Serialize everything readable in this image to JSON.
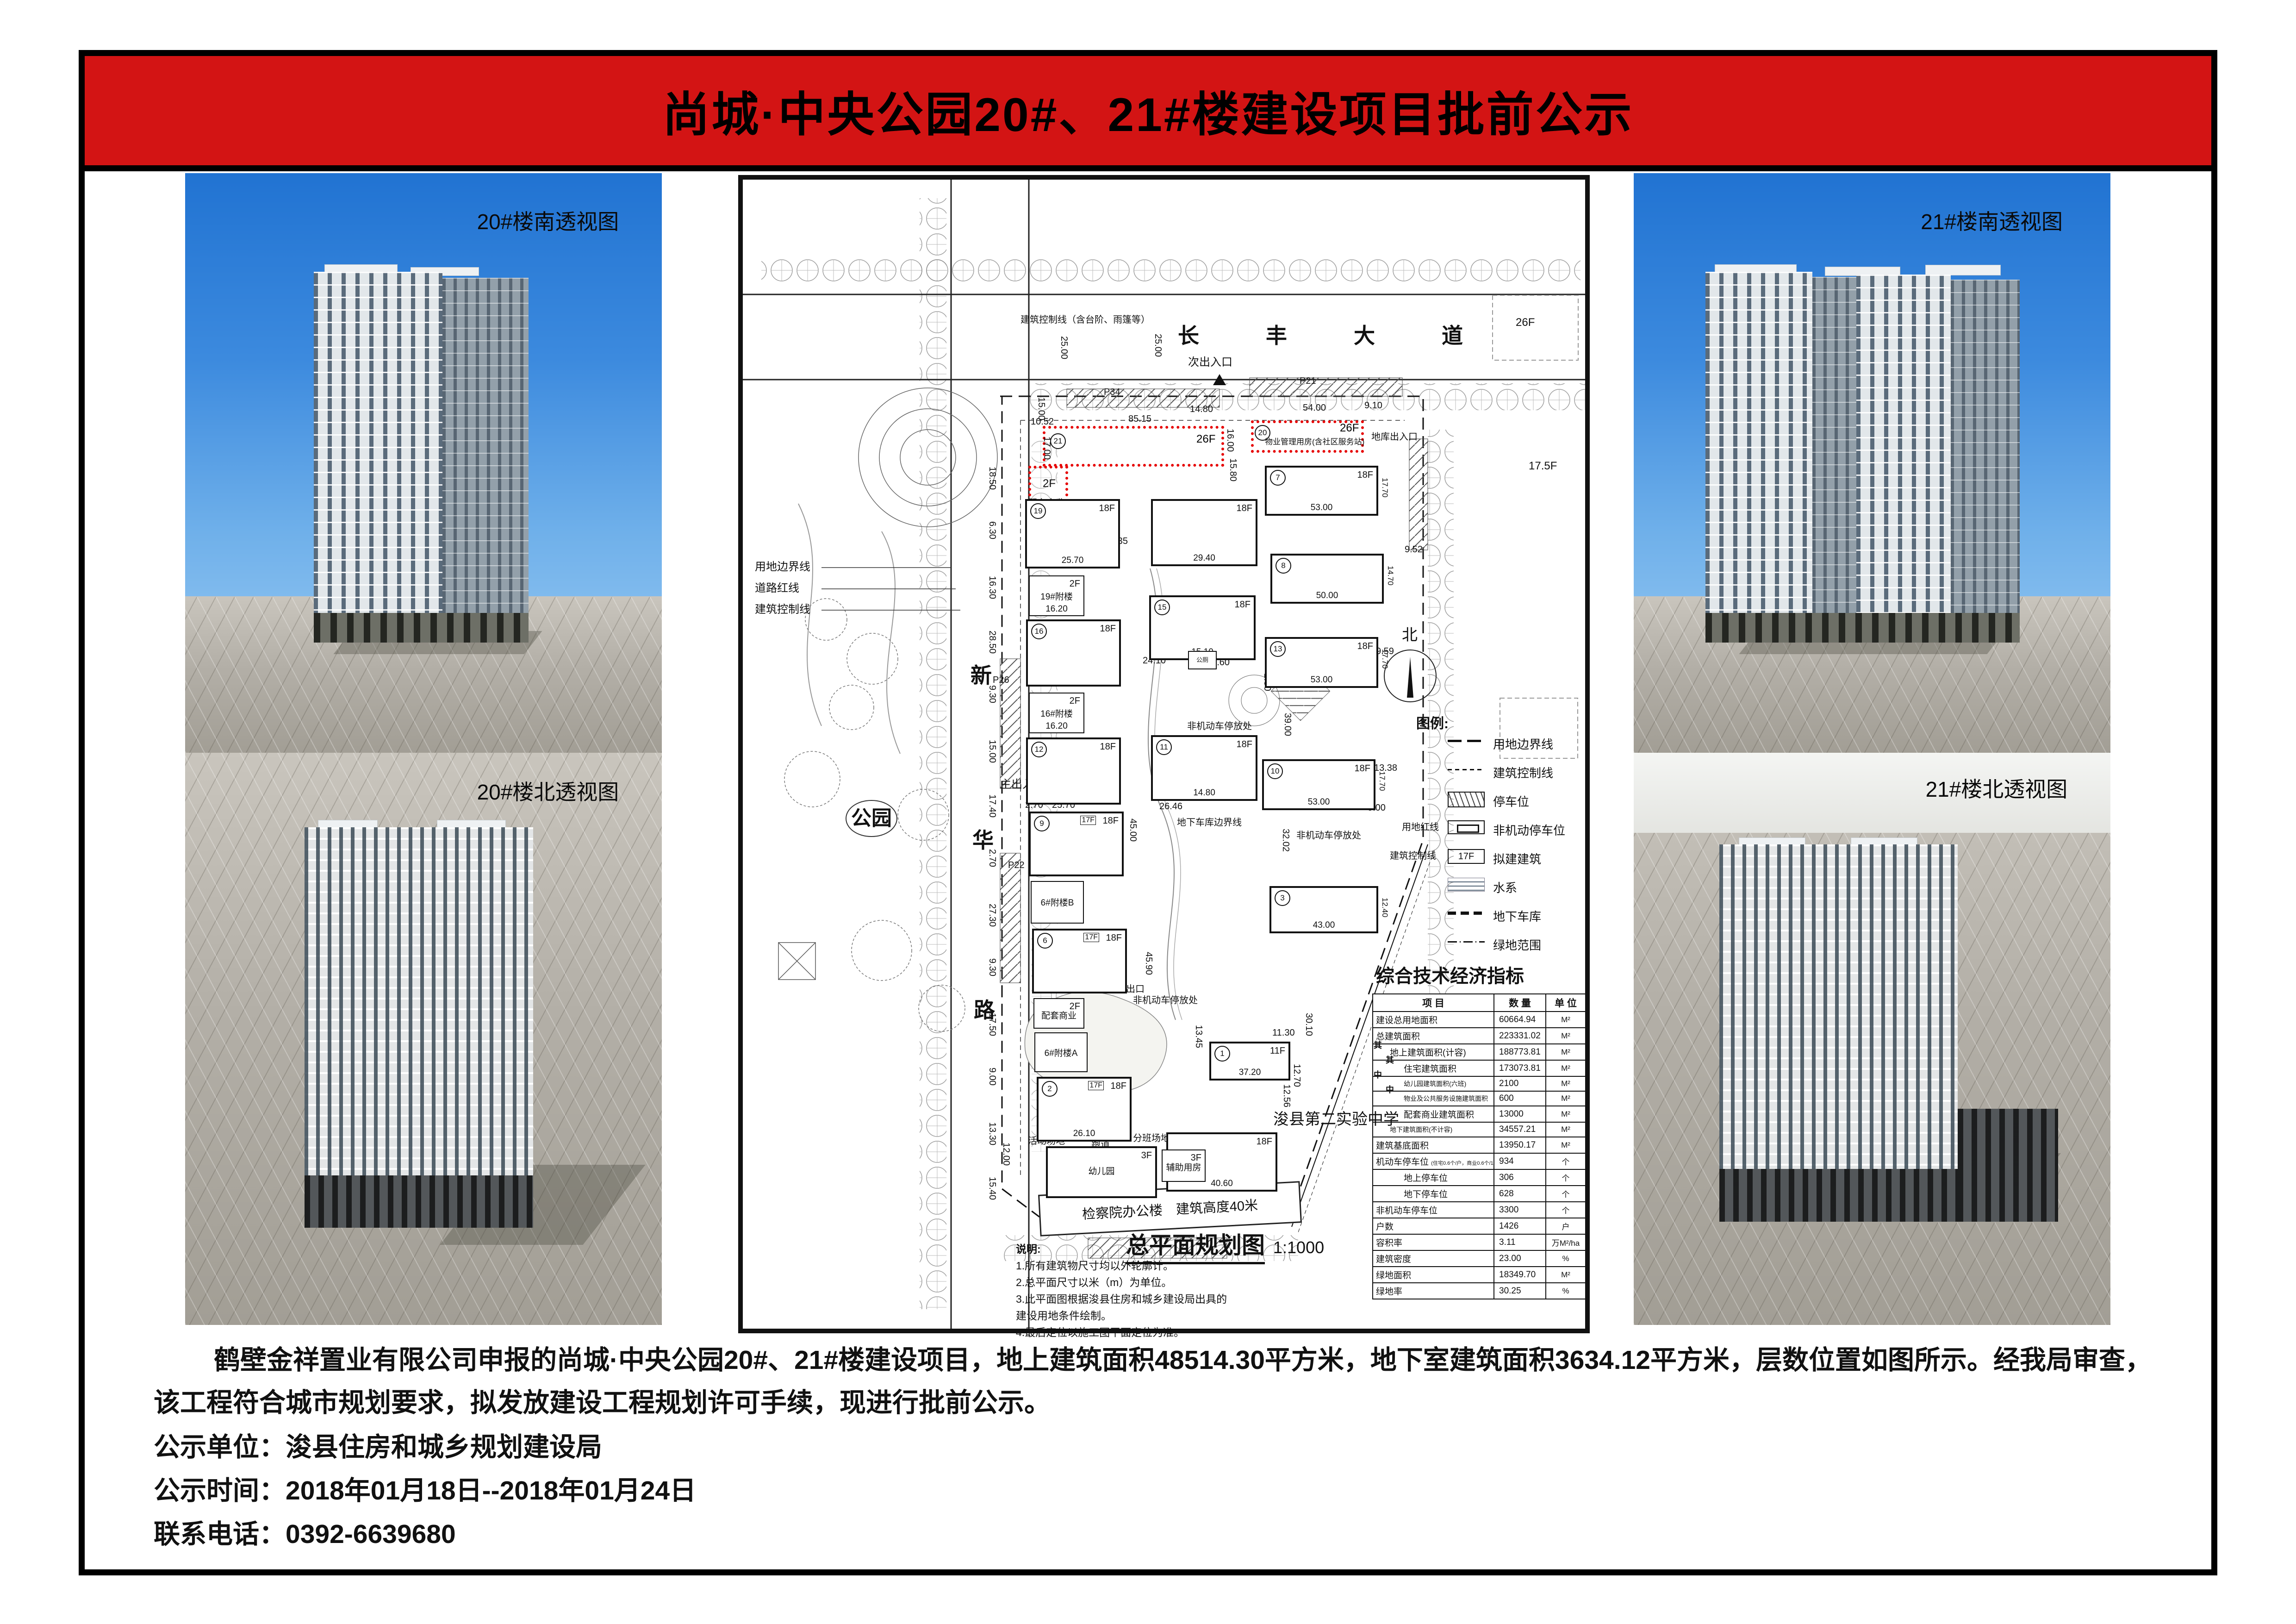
{
  "title": "尚城·中央公园20#、21#楼建设项目批前公示",
  "banner_color": "#d31414",
  "panels": [
    {
      "label": "20#楼南透视图"
    },
    {
      "label": "20#楼北透视图"
    },
    {
      "label": "21#楼南透视图"
    },
    {
      "label": "21#楼北透视图"
    }
  ],
  "plan": {
    "map_title": "总平面规划图",
    "map_scale": "1:1000",
    "road_top": "长丰大道",
    "road_left": "新华路",
    "park": "公园",
    "north": "北",
    "legend_title": "图例:",
    "legend": [
      "用地边界线",
      "建筑控制线",
      "停车位",
      "非机动停车位",
      "拟建建筑",
      "水系",
      "地下车库",
      "绿地范围"
    ],
    "legend_floor": "17F",
    "table": {
      "title": "综合技术经济指标",
      "headers": [
        "项  目",
        "数  量",
        "单  位"
      ],
      "side_group": "其中",
      "rows": [
        {
          "label": "建设总用地面积",
          "qty": "60664.94",
          "unit": "M²",
          "indent": 0
        },
        {
          "label": "总建筑面积",
          "qty": "223331.02",
          "unit": "M²",
          "indent": 0
        },
        {
          "label": "地上建筑面积(计容)",
          "qty": "188773.81",
          "unit": "M²",
          "indent": 1
        },
        {
          "label": "住宅建筑面积",
          "qty": "173073.81",
          "unit": "M²",
          "indent": 2
        },
        {
          "label": "幼儿园建筑面积(六班)",
          "qty": "2100",
          "unit": "M²",
          "indent": 2
        },
        {
          "label": "物业及公共服务设施建筑面积",
          "qty": "600",
          "unit": "M²",
          "indent": 2
        },
        {
          "label": "配套商业建筑面积",
          "qty": "13000",
          "unit": "M²",
          "indent": 2
        },
        {
          "label": "地下建筑面积(不计容)",
          "qty": "34557.21",
          "unit": "M²",
          "indent": 1
        },
        {
          "label": "建筑基底面积",
          "qty": "13950.17",
          "unit": "M²",
          "indent": 0
        },
        {
          "label": "机动车停车位",
          "note": "(住宅0.6个/户，商业0.6个/100m²)",
          "qty": "934",
          "unit": "个",
          "indent": 0
        },
        {
          "label": "地上停车位",
          "qty": "306",
          "unit": "个",
          "indent": 2
        },
        {
          "label": "地下停车位",
          "qty": "628",
          "unit": "个",
          "indent": 2
        },
        {
          "label": "非机动车停车位",
          "qty": "3300",
          "unit": "个",
          "indent": 0
        },
        {
          "label": "户数",
          "qty": "1426",
          "unit": "户",
          "indent": 0
        },
        {
          "label": "容积率",
          "qty": "3.11",
          "unit": "万M²/ha",
          "indent": 0
        },
        {
          "label": "建筑密度",
          "qty": "23.00",
          "unit": "%",
          "indent": 0
        },
        {
          "label": "绿地面积",
          "qty": "18349.70",
          "unit": "M²",
          "indent": 0
        },
        {
          "label": "绿地率",
          "qty": "30.25",
          "unit": "%",
          "indent": 0
        }
      ]
    },
    "notes": {
      "title": "说明:",
      "lines": [
        "1.所有建筑物尺寸均以外轮廓计。",
        "2.总平面尺寸以米（m）为单位。",
        "3.此平面图根据浚县住房和城乡建设局出具的",
        "  建设用地条件绘制。",
        "4.最后定位以施工图平面定位为准。"
      ]
    },
    "red": {
      "left_no": "21",
      "right_no": "20",
      "floors": "26F",
      "left_use_floor": "2F",
      "left_use": "配套商业",
      "right_use": "物业管理用房(含社区服务站)",
      "fire_lane": "消防通道"
    },
    "labels": {
      "ctrl_top": "建筑控制线（含台阶、雨篷等）",
      "entr_secondary": "次出入口",
      "entr_garage": "地库出入口",
      "entr_main": "主出入口",
      "garage_exit": "地库出口",
      "non_motor": "非机动车停放处",
      "toilet": "公厕",
      "boundary": [
        "用地边界线",
        "道路红线",
        "建筑控制线"
      ],
      "red_line": "用地红线",
      "ctrl_line": "建筑控制线",
      "garage_boundary": "地下车库边界线",
      "school": "浚县第二实验中学",
      "procuratorate": "检察院办公楼　建筑高度40米",
      "activity": [
        "活动场地",
        "跑道",
        "分班场地"
      ],
      "aux_room": "辅助用房",
      "neighbor_26f": "26F",
      "neighbor_175f": "17.5F"
    },
    "parkings": [
      "P34",
      "P21",
      "P26",
      "P22"
    ],
    "buildings": [
      {
        "no": "19",
        "floors": "18F",
        "dim": "25.70"
      },
      {
        "name": "19#附楼",
        "floors": "2F",
        "dim": "16.20"
      },
      {
        "no": "16",
        "floors": "18F"
      },
      {
        "name": "16#附楼",
        "floors": "2F",
        "dim": "16.20"
      },
      {
        "no": "12",
        "floors": "18F"
      },
      {
        "no": "9",
        "floors": "18F",
        "sub": "17F"
      },
      {
        "name": "6#附楼B"
      },
      {
        "no": "6",
        "floors": "18F",
        "sub": "17F"
      },
      {
        "name": "配套商业",
        "floors": "2F"
      },
      {
        "name": "6#附楼A"
      },
      {
        "no": "2",
        "floors": "18F",
        "sub": "17F",
        "dim": "26.10"
      },
      {
        "name": "幼儿园",
        "floors": "3F"
      },
      {
        "floors": "18F",
        "dim": "29.40"
      },
      {
        "no": "15",
        "floors": "18F",
        "dim": "15.10"
      },
      {
        "no": "11",
        "floors": "18F",
        "dim": "14.80"
      },
      {
        "floors": "18F",
        "dim": "40.60"
      },
      {
        "no": "7",
        "floors": "18F",
        "dim": "53.00",
        "dim2": "17.70"
      },
      {
        "no": "8",
        "dim": "50.00",
        "dim2": "14.70"
      },
      {
        "no": "13",
        "floors": "18F",
        "dim": "53.00",
        "dim2": "17.70"
      },
      {
        "no": "10",
        "floors": "18F",
        "dim": "53.00",
        "dim2": "17.70"
      },
      {
        "no": "3",
        "dim": "43.00",
        "dim2": "12.40"
      },
      {
        "no": "1",
        "floors": "11F",
        "dim": "37.20"
      },
      {
        "name": "公厕"
      },
      {
        "name": "辅助用房",
        "floors": "3F"
      }
    ],
    "dims_top": [
      "10.52",
      "85.15",
      "14.80",
      "54.00",
      "9.10"
    ],
    "dims_vert": [
      "25.00",
      "25.00",
      "15.00",
      "17.00",
      "16.00",
      "15.80"
    ],
    "dims_left": [
      "18.50",
      "6.30",
      "16.30",
      "28.50",
      "9.30",
      "15.00",
      "17.40",
      "2.70",
      "27.30",
      "9.30",
      "17.50",
      "9.00",
      "13.30",
      "15.40"
    ],
    "dims_misc": [
      "38.35",
      "16.40",
      "45.00",
      "45.90",
      "39.37",
      "39.00",
      "32.02",
      "9.52",
      "9.59",
      "13.38",
      "18.10",
      "41.60",
      "1.80",
      "9.00",
      "30.10",
      "12.56",
      "12.70",
      "13.45",
      "11.30",
      "21.67",
      "12.00",
      "2.70",
      "25.70",
      "26.46",
      "20.55",
      "24.10"
    ]
  },
  "footer": {
    "lines": [
      "鹤壁金祥置业有限公司申报的尚城·中央公园20#、21#楼建设项目，地上建筑面积48514.30平方米，地下室建筑面积3634.12平方米，层数位置如图所示。经我局审查，",
      "该工程符合城市规划要求，拟发放建设工程规划许可手续，现进行批前公示。",
      "公示单位：浚县住房和城乡规划建设局",
      "公示时间：2018年01月18日--2018年01月24日",
      "联系电话：0392-6639680"
    ]
  }
}
